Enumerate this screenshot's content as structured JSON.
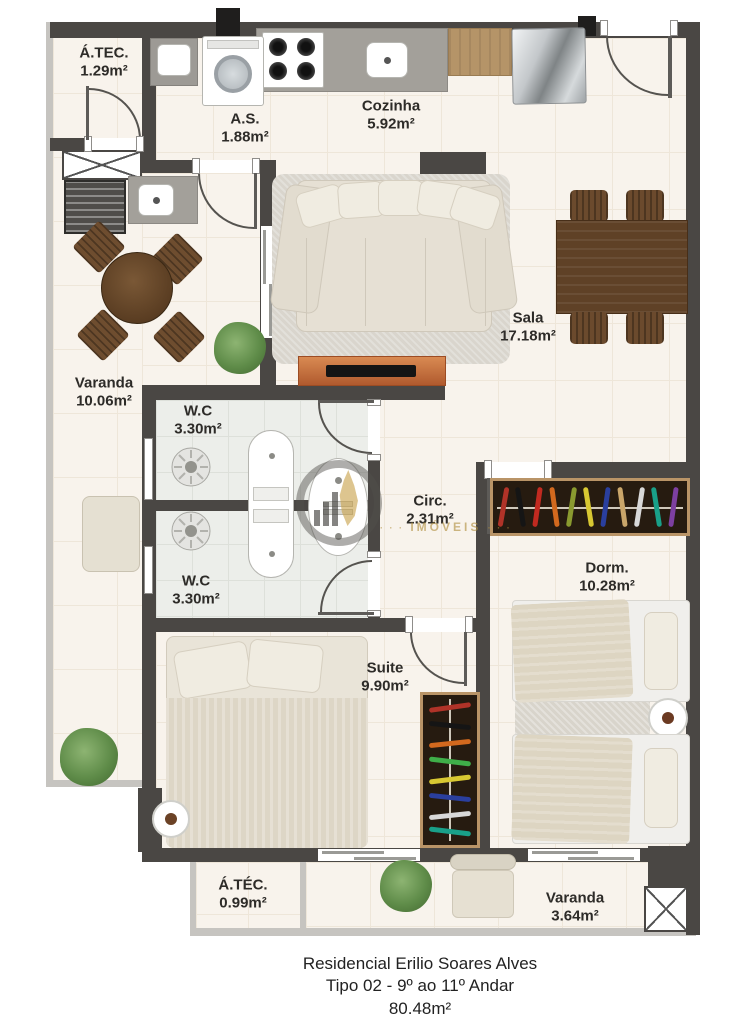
{
  "plan": {
    "rooms": [
      {
        "name": "Á.TEC.",
        "area": "1.29m²"
      },
      {
        "name": "A.S.",
        "area": "1.88m²"
      },
      {
        "name": "Cozinha",
        "area": "5.92m²"
      },
      {
        "name": "Sala",
        "area": "17.18m²"
      },
      {
        "name": "Varanda",
        "area": "10.06m²"
      },
      {
        "name": "W.C",
        "area": "3.30m²"
      },
      {
        "name": "W.C",
        "area": "3.30m²"
      },
      {
        "name": "Circ.",
        "area": "2.31m²"
      },
      {
        "name": "Dorm.",
        "area": "10.28m²"
      },
      {
        "name": "Suite",
        "area": "9.90m²"
      },
      {
        "name": "Á.TÉC.",
        "area": "0.99m²"
      },
      {
        "name": "Varanda",
        "area": "3.64m²"
      }
    ],
    "footer": {
      "line1": "Residencial Erilio Soares Alves",
      "line2": "Tipo 02 - 9º ao 11º Andar",
      "line3": "80.48m²"
    },
    "watermark": {
      "text": "IMÓVEIS",
      "dots": "· · ·"
    },
    "colors": {
      "wall": "#4a4744",
      "floor": "#f8f3ec",
      "bath_floor": "#eceeea",
      "wood": "#5f4126",
      "tv_stand": "#c4673c",
      "watermark_gold": "#b08e3e"
    }
  }
}
